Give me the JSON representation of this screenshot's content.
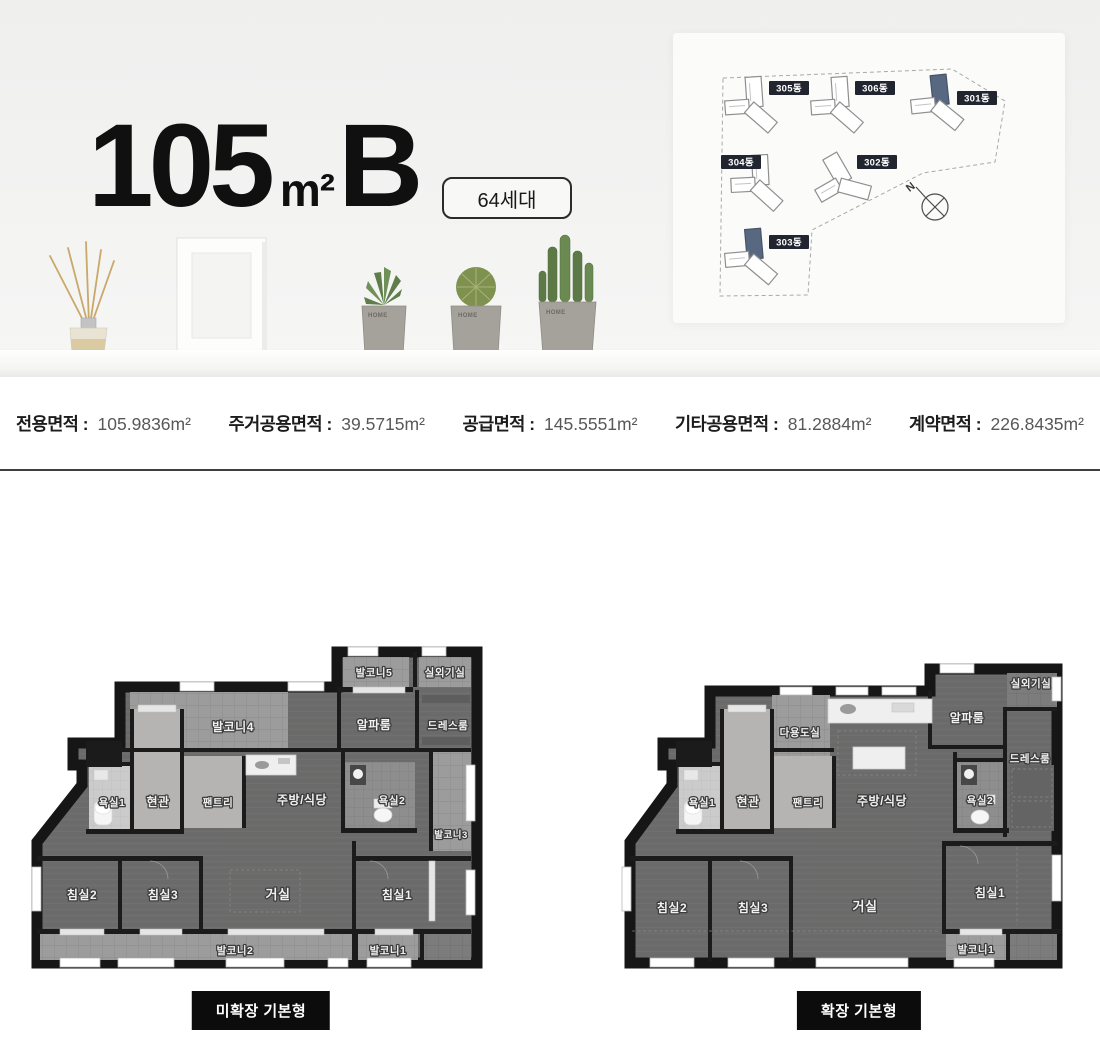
{
  "header": {
    "size": "105",
    "unit": "m²",
    "type": "B",
    "badge": "64세대"
  },
  "site_map": {
    "compass": "N",
    "buildings": [
      {
        "name": "305동",
        "highlighted": false
      },
      {
        "name": "306동",
        "highlighted": false
      },
      {
        "name": "301동",
        "highlighted": true
      },
      {
        "name": "304동",
        "highlighted": false
      },
      {
        "name": "302동",
        "highlighted": false
      },
      {
        "name": "303동",
        "highlighted": true
      }
    ]
  },
  "shelf": {
    "pot_label": "HOME"
  },
  "area_info": [
    {
      "label": "전용면적 :",
      "value": "105.9836m²"
    },
    {
      "label": "주거공용면적 :",
      "value": "39.5715m²"
    },
    {
      "label": "공급면적 :",
      "value": "145.5551m²"
    },
    {
      "label": "기타공용면적 :",
      "value": "81.2884m²"
    },
    {
      "label": "계약면적 :",
      "value": "226.8435m²"
    }
  ],
  "plans": [
    {
      "caption": "미확장 기본형",
      "rooms": {
        "balcony5": "발코니5",
        "outdoor": "실외기실",
        "balcony4": "발코니4",
        "alpha": "알파룸",
        "dress": "드레스룸",
        "bath1": "욕실1",
        "entrance": "현관",
        "pantry": "팬트리",
        "kitchen": "주방/식당",
        "bath2": "욕실2",
        "balcony3": "발코니3",
        "bed2": "침실2",
        "bed3": "침실3",
        "living": "거실",
        "bed1": "침실1",
        "balcony2": "발코니2",
        "balcony1": "발코니1"
      }
    },
    {
      "caption": "확장 기본형",
      "rooms": {
        "outdoor": "실외기실",
        "utility": "다용도실",
        "alpha": "알파룸",
        "dress": "드레스룸",
        "bath1": "욕실1",
        "entrance": "현관",
        "pantry": "팬트리",
        "kitchen": "주방/식당",
        "bath2": "욕실2",
        "bed2": "침실2",
        "bed3": "침실3",
        "living": "거실",
        "bed1": "침실1",
        "balcony1": "발코니1"
      }
    }
  ]
}
